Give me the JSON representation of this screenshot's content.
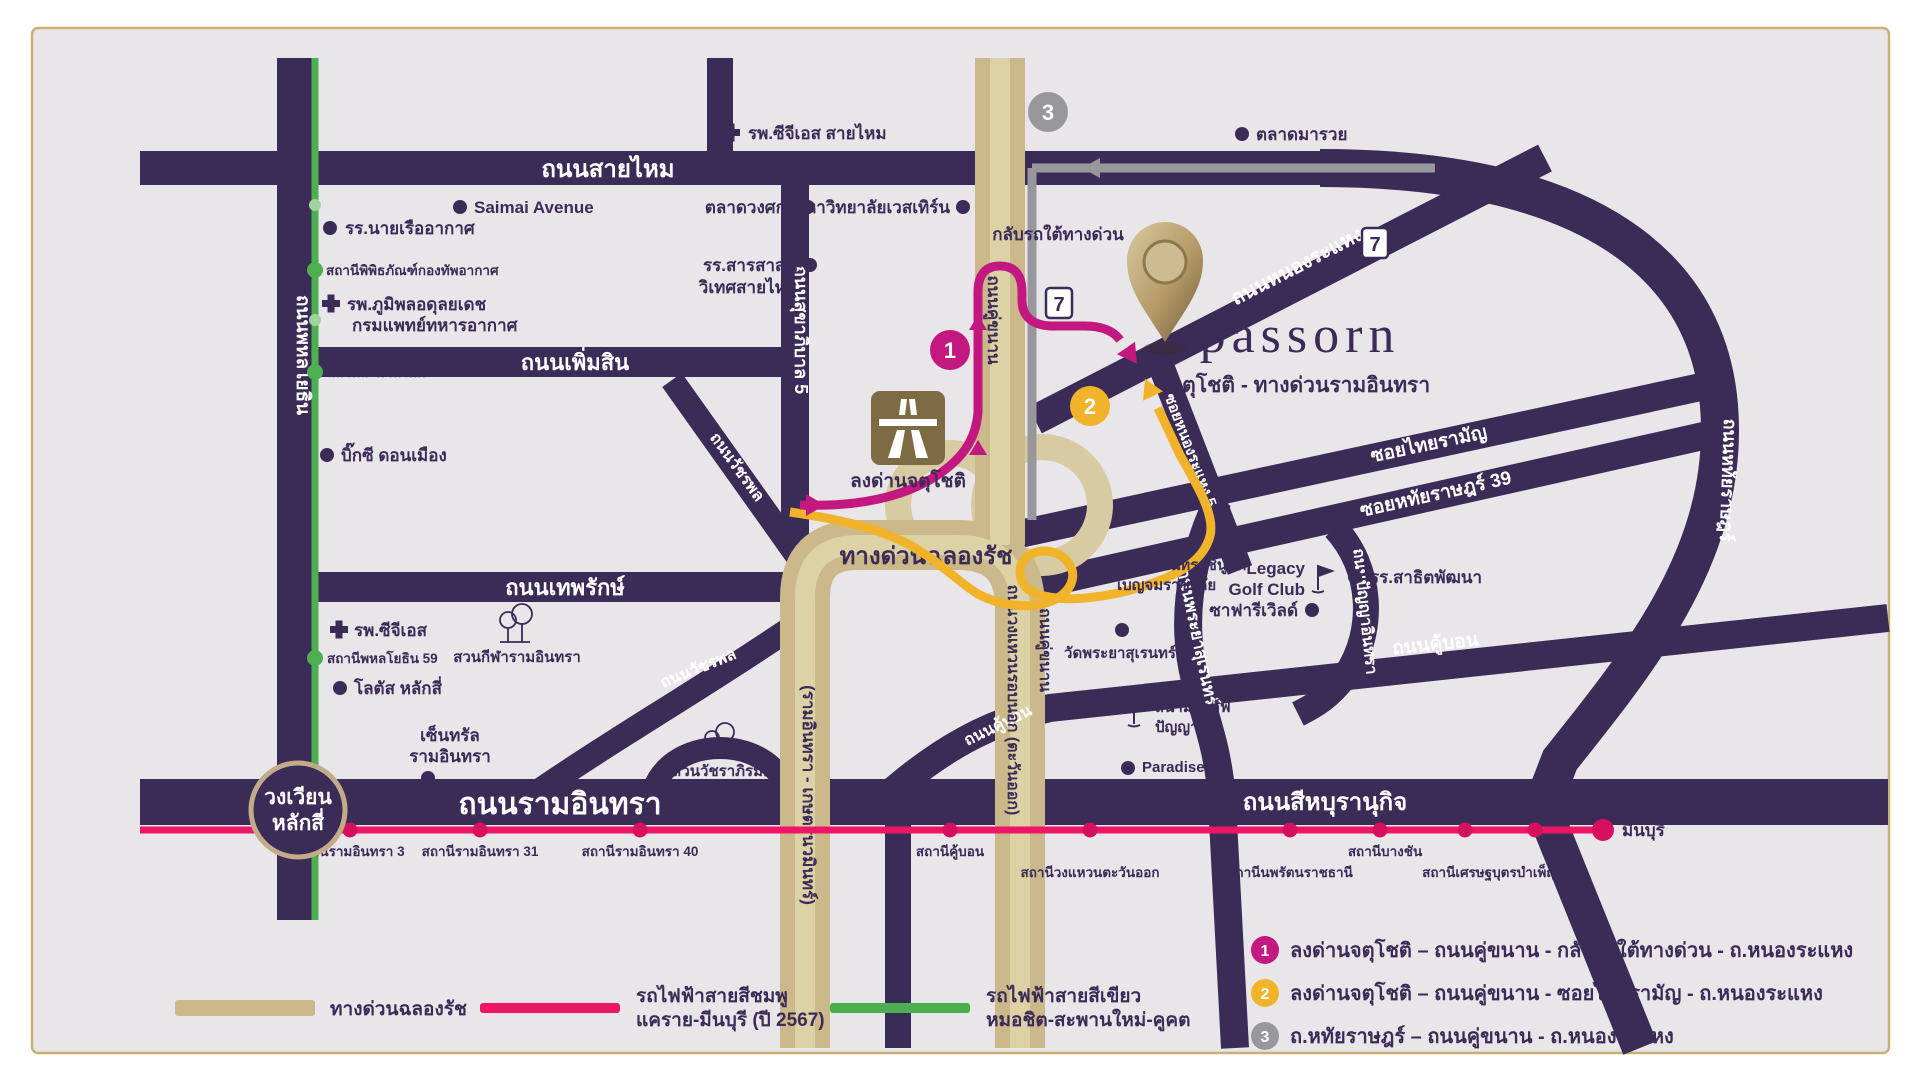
{
  "project": {
    "name": "passorn",
    "subtitle": "จตุโชติ - ทางด่วนรามอินทรา"
  },
  "roads": {
    "saimai": "ถนนสายไหม",
    "phahonyothin": "ถนนพหลโยธิน",
    "phoemsin": "ถนนเพิ่มสิน",
    "sukhaphiban5": "ถนนสุขาภิบาล 5",
    "watcharaphon": "ถนนวัชรพล",
    "theparak": "ถนนเทพรักษ์",
    "ramindra": "ถนนรามอินทรา",
    "sihaburanukit": "ถนนสีหบุรานุกิจ",
    "nongrahaeng": "ถนนหนองระแหง",
    "soi_nongrahaeng5": "ซอยหนองระแหง 5",
    "thairaman": "ซอยไทยรามัญ",
    "hathairat39": "ซอยหทัยราษฎร์ 39",
    "hathairat": "ถนนหทัยราษฎร์",
    "panyaindra": "ถนนปัญญาอินทรา",
    "khubon": "ถนนคู้บอน",
    "phrayasuren": "ถนนพระยาสุเรนทร์",
    "parallel": "ถนนคู่ขนาน",
    "outer_ring": "ถนนวงแหวนรอบนอก (ตะวันออก)",
    "expressway": "ทางด่วนฉลองรัช",
    "expressway_section": "(รามอินทรา - เกษตรนวมินทร์)",
    "roundabout_line1": "วงเวียน",
    "roundabout_line2": "หลักสี่"
  },
  "markers": {
    "exit_label": "ลงด่านจตุโชติ",
    "uturn_label": "กลับรถใต้ทางด่วน",
    "seven_eleven": "7"
  },
  "badges": {
    "one": "1",
    "two": "2",
    "three": "3"
  },
  "pois": {
    "cgs_saimai": "รพ.ซีจีเอส สายไหม",
    "saimai_avenue": "Saimai Avenue",
    "wongsakon": "ตลาดวงศกร",
    "western_univ": "มหาวิทยาลัยเวสเทิร์น",
    "maruay": "ตลาดมารวย",
    "navy_school": "รร.นายเรืออากาศ",
    "sarasas_line1": "รร.สารสาสน์",
    "sarasas_line2": "วิเทศสายไหม",
    "bhumibol_line1": "รพ.ภูมิพลอดุลยเดช",
    "bhumibol_line2": "กรมแพทย์ทหารอากาศ",
    "bigc": "บิ๊กซี ดอนเมือง",
    "cgs": "รพ.ซีจีเอส",
    "lotus": "โลตัส หลักสี่",
    "central_line1": "เซ็นทรัล",
    "central_line2": "รามอินทรา",
    "ramindra_sport_park": "สวนกีฬารามอินทรา",
    "watchara_park": "สวนวัชราภิรมย์",
    "nawamin_line1": "รร. นวมินทราชินูทิศ",
    "nawamin_line2": "เบญจมราชาลัย",
    "legacy_line1": "Legacy",
    "legacy_line2": "Golf Club",
    "safari_world": "ซาฟารีเวิลด์",
    "satit_pattana": "รร.สาธิตพัฒนา",
    "wat_phrayasuren": "วัดพระยาสุเรนทร์",
    "panya_line1": "สนามกอล์ฟ",
    "panya_line2": "ปัญญา",
    "paradise_line1": "Paradise",
    "paradise_line2": "Fashionisland"
  },
  "stations": {
    "green": [
      "สถานีพิพิธภัณฑ์กองทัพอากาศ",
      "สถานีสะพานใหม่",
      "สถานีพหลโยธิน 59"
    ],
    "pink": [
      "สถานีรามอินทรา 3",
      "สถานีรามอินทรา 31",
      "สถานีรามอินทรา 40",
      "สถานีคู้บอน",
      "สถานีวงแหวนตะวันออก",
      "สถานีนพรัตนราชธานี",
      "สถานีบางชัน",
      "สถานีเศรษฐบุตรบำเพ็ญ"
    ],
    "pink_terminus": "มีนบุรี"
  },
  "legend": {
    "expressway": "ทางด่วนฉลองรัช",
    "pink_line1": "รถไฟฟ้าสายสีชมพู",
    "pink_line2": "แคราย-มีนบุรี (ปี 2567)",
    "green_line1": "รถไฟฟ้าสายสีเขียว",
    "green_line2": "หมอชิต-สะพานใหม่-คูคต"
  },
  "route_notes": [
    {
      "num": "1",
      "text": "ลงด่านจตุโชติ – ถนนคู่ขนาน - กลับรถใต้ทางด่วน - ถ.หนองระแหง"
    },
    {
      "num": "2",
      "text": "ลงด่านจตุโชติ – ถนนคู่ขนาน - ซอยไทยรามัญ - ถ.หนองระแหง"
    },
    {
      "num": "3",
      "text": "ถ.หทัยราษฎร์ – ถนนคู่ขนาน - ถ.หนองระแหง"
    }
  ],
  "colors": {
    "road_purple": "#3b2b57",
    "expressway_tan": "#cbb88b",
    "expressway_stripe": "#ddd1a6",
    "pink_line": "#ec1566",
    "magenta_route": "#c2187f",
    "yellow_route": "#f0b32a",
    "gray_route": "#98989c",
    "green_line": "#4caf50",
    "map_bg": "#e9e6ea",
    "frame": "#c9b173",
    "pin_gold": "#b49a67"
  }
}
